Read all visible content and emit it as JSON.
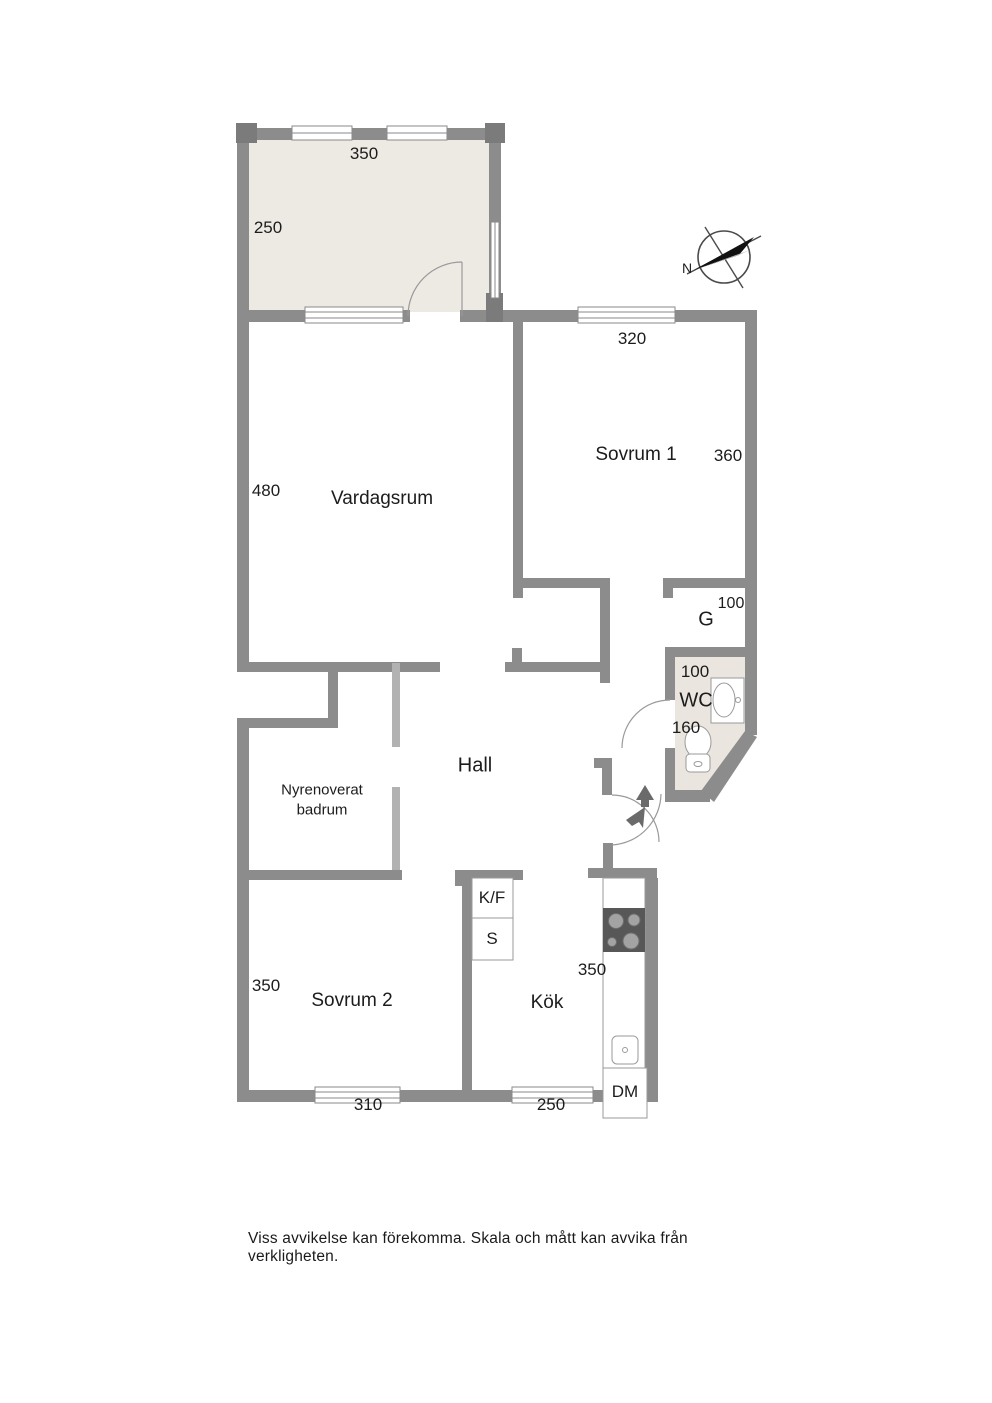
{
  "page": {
    "type": "floor-plan",
    "background": "#ffffff"
  },
  "rooms": {
    "balcony": {
      "dim_width": "350",
      "dim_height": "250"
    },
    "vardagsrum": {
      "label": "Vardagsrum",
      "dim_height": "480"
    },
    "sovrum1": {
      "label": "Sovrum 1",
      "dim_width": "320",
      "dim_height": "360"
    },
    "closet_g": {
      "label": "G",
      "dim": "100"
    },
    "wc": {
      "label": "WC",
      "dim_width": "100",
      "dim_height": "160"
    },
    "hall": {
      "label": "Hall"
    },
    "badrum": {
      "label_line1": "Nyrenoverat",
      "label_line2": "badrum"
    },
    "sovrum2": {
      "label": "Sovrum 2",
      "dim_height": "350",
      "dim_width": "310"
    },
    "kok": {
      "label": "Kök",
      "dim_height": "350",
      "dim_width": "250"
    }
  },
  "fixtures": {
    "fridge_freezer": "K/F",
    "pantry": "S",
    "dishwasher": "DM"
  },
  "compass": {
    "north_label": "N"
  },
  "footer": {
    "disclaimer": "Viss avvikelse kan förekomma. Skala och mått kan avvika från verkligheten."
  },
  "colors": {
    "wall": "#8c8c8c",
    "wall_dark": "#7b7b7b",
    "partition_light": "#b2b2b2",
    "balcony_fill": "#edeae4",
    "wc_fill": "#eae6df",
    "stove_fill": "#575757",
    "arrow": "#6a6a6a",
    "text": "#1c1c1c"
  }
}
